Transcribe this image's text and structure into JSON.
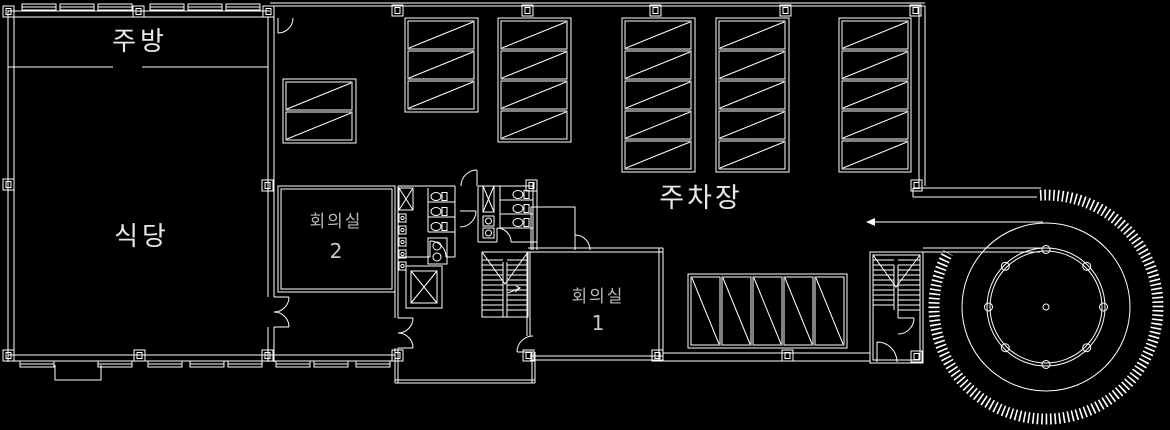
{
  "drawing": {
    "type": "architectural-floor-plan",
    "colors": {
      "background": "#000000",
      "line": "#ffffff",
      "label_bright": "#e8e8e8",
      "label_dim": "#b9b9b9"
    },
    "rooms": {
      "kitchen": {
        "label": "주방"
      },
      "dining": {
        "label": "식당"
      },
      "meeting_room_2": {
        "label": "회의실",
        "number": "2"
      },
      "meeting_room_1": {
        "label": "회의실",
        "number": "1"
      },
      "parking": {
        "label": "주차장"
      }
    }
  }
}
